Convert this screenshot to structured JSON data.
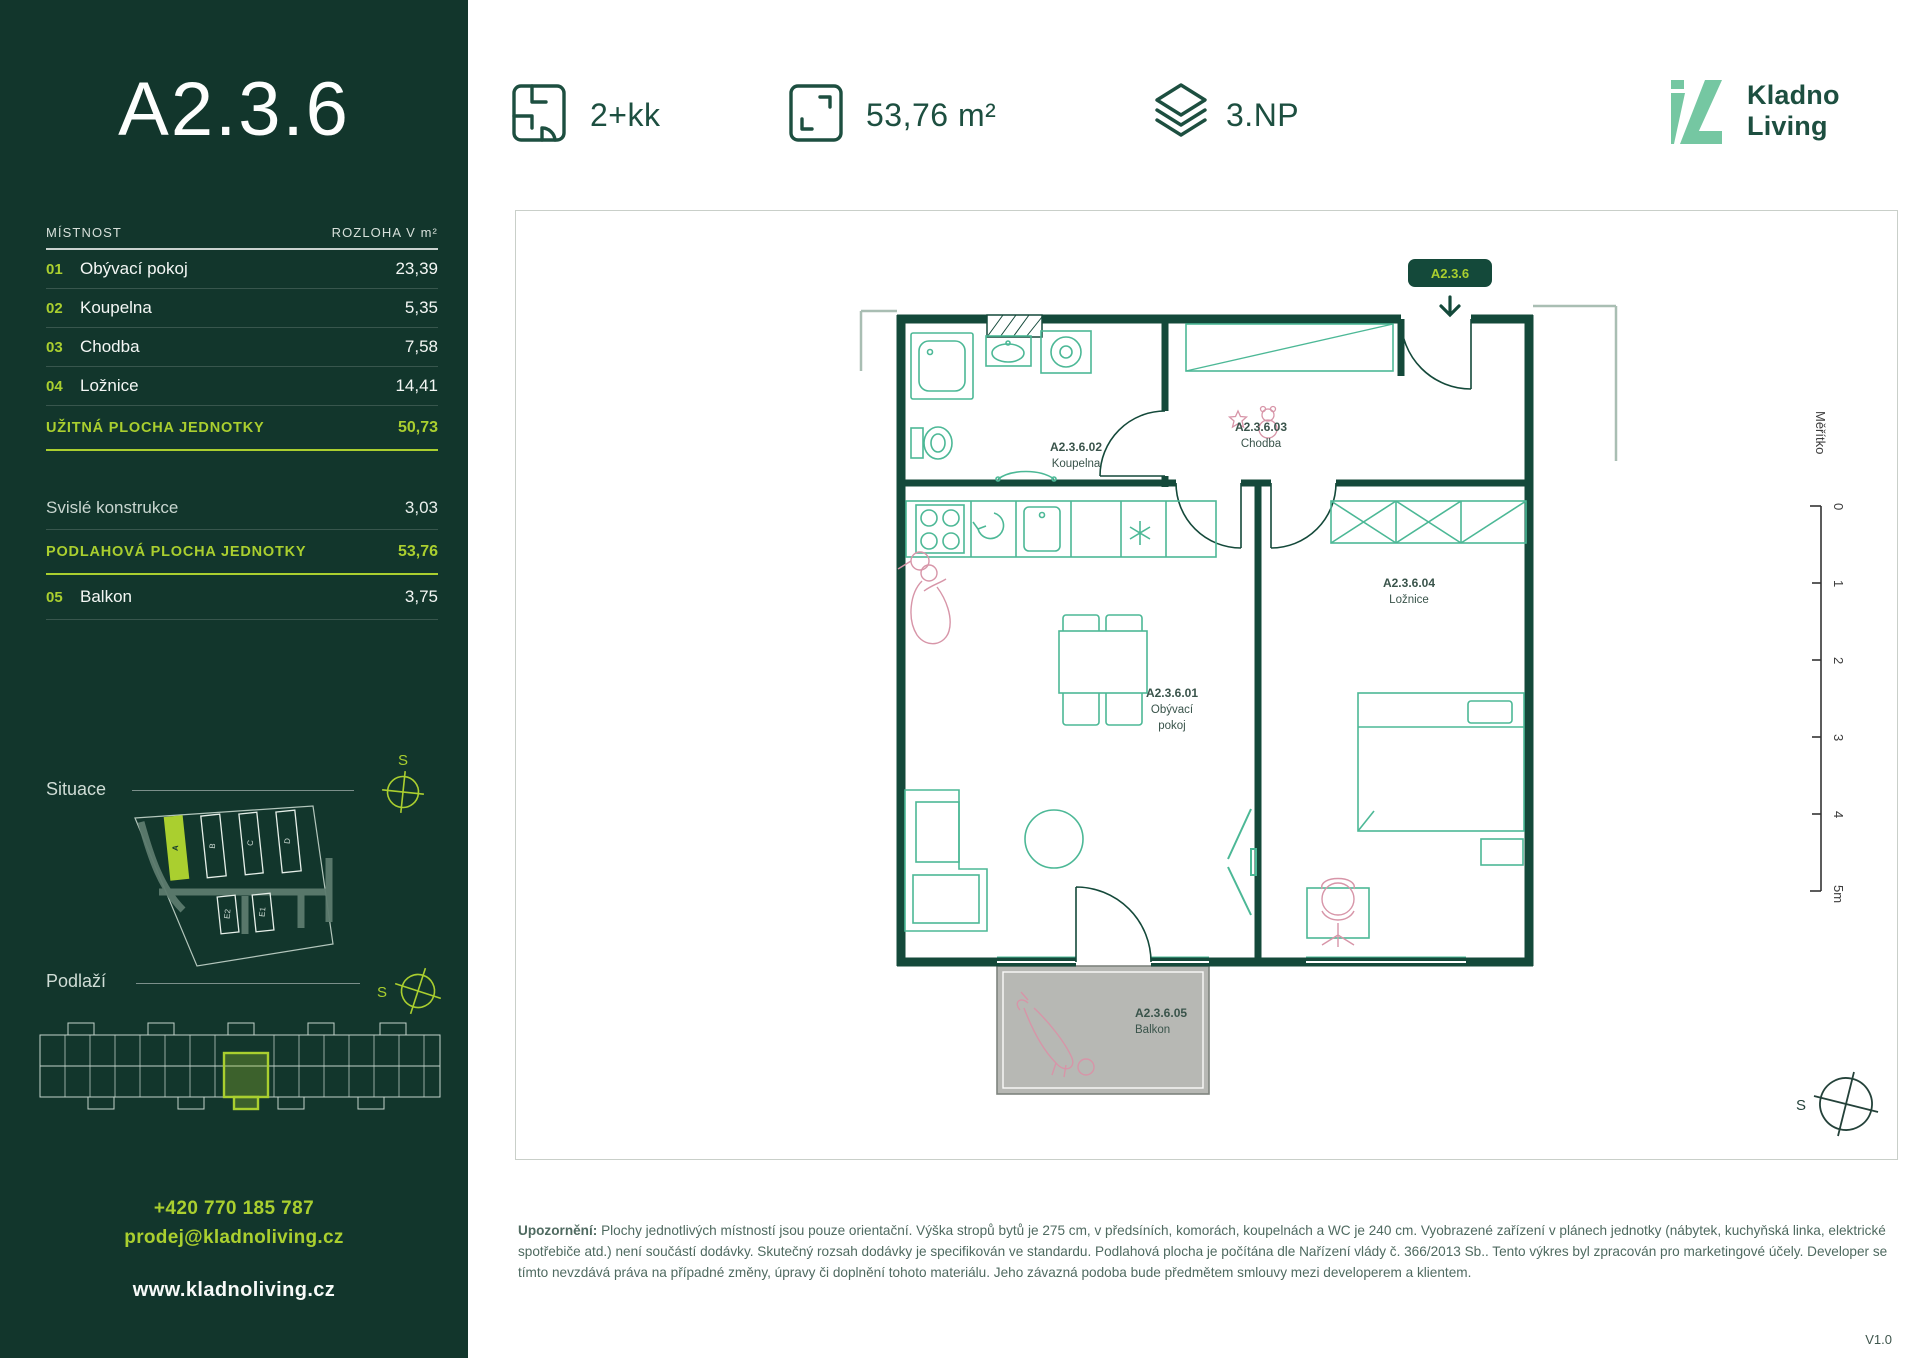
{
  "sidebar": {
    "unit_code": "A2.3.6",
    "table": {
      "col_room": "MÍSTNOST",
      "col_area": "ROZLOHA V m²",
      "rooms": [
        {
          "num": "01",
          "name": "Obývací pokoj",
          "area": "23,39"
        },
        {
          "num": "02",
          "name": "Koupelna",
          "area": "5,35"
        },
        {
          "num": "03",
          "name": "Chodba",
          "area": "7,58"
        },
        {
          "num": "04",
          "name": "Ložnice",
          "area": "14,41"
        }
      ],
      "usable": {
        "label": "UŽITNÁ PLOCHA JEDNOTKY",
        "value": "50,73"
      },
      "vertical": {
        "label": "Svislé konstrukce",
        "value": "3,03"
      },
      "floor_area": {
        "label": "PODLAHOVÁ PLOCHA JEDNOTKY",
        "value": "53,76"
      },
      "balcony": {
        "num": "05",
        "name": "Balkon",
        "area": "3,75"
      }
    },
    "situace_label": "Situace",
    "podlazi_label": "Podlaží",
    "compass_letter": "S",
    "site_buildings": {
      "a": "A",
      "b": "B",
      "c": "C",
      "d": "D",
      "e2": "E2",
      "e1": "E1"
    },
    "contact": {
      "phone": "+420 770 185 787",
      "email": "prodej@kladnoliving.cz",
      "web": "www.kladnoliving.cz"
    }
  },
  "header": {
    "layout": "2+kk",
    "area": "53,76 m²",
    "floor": "3.NP",
    "brand_line1": "Kladno",
    "brand_line2": "Living"
  },
  "plan": {
    "chip": "A2.3.6",
    "rooms": {
      "living": {
        "code": "A2.3.6.01",
        "name1": "Obývací",
        "name2": "pokoj"
      },
      "bath": {
        "code": "A2.3.6.02",
        "name": "Koupelna"
      },
      "hall": {
        "code": "A2.3.6.03",
        "name": "Chodba"
      },
      "bed": {
        "code": "A2.3.6.04",
        "name": "Ložnice"
      },
      "balcony": {
        "code": "A2.3.6.05",
        "name": "Balkon"
      }
    },
    "scale": {
      "label": "Měřítko",
      "ticks": [
        "0",
        "1",
        "2",
        "3",
        "4",
        "5m"
      ]
    },
    "compass_letter": "S"
  },
  "footer": {
    "disclaimer_label": "Upozornění:",
    "disclaimer_text": " Plochy jednotlivých místností jsou pouze orientační. Výška stropů bytů je 275 cm, v předsíních, komorách, koupelnách a WC je 240 cm. Vyobrazené zařízení v plánech jednotky (nábytek, kuchyňská linka, elektrické spotřebiče atd.) není součástí dodávky. Skutečný rozsah dodávky je specifikován ve standardu. Podlahová plocha je počítána dle Nařízení vlády č. 366/2013 Sb.. Tento výkres byl zpracován pro marketingové účely. Developer se tímto nevzdává práva na případné změny, úpravy či doplnění tohoto materiálu. Jeho závazná podoba bude předmětem smlouvy mezi developerem a klientem.",
    "version": "V1.0"
  },
  "colors": {
    "sidebar_bg": "#12362c",
    "accent_lime": "#aacf2f",
    "brand_green": "#1d4f40",
    "brand_mint": "#75c7a2",
    "wall_green": "#14493a",
    "furniture_teal": "#4cb896",
    "sketch_pink": "#d795a8",
    "balcony_gray": "#b7b8b4"
  }
}
